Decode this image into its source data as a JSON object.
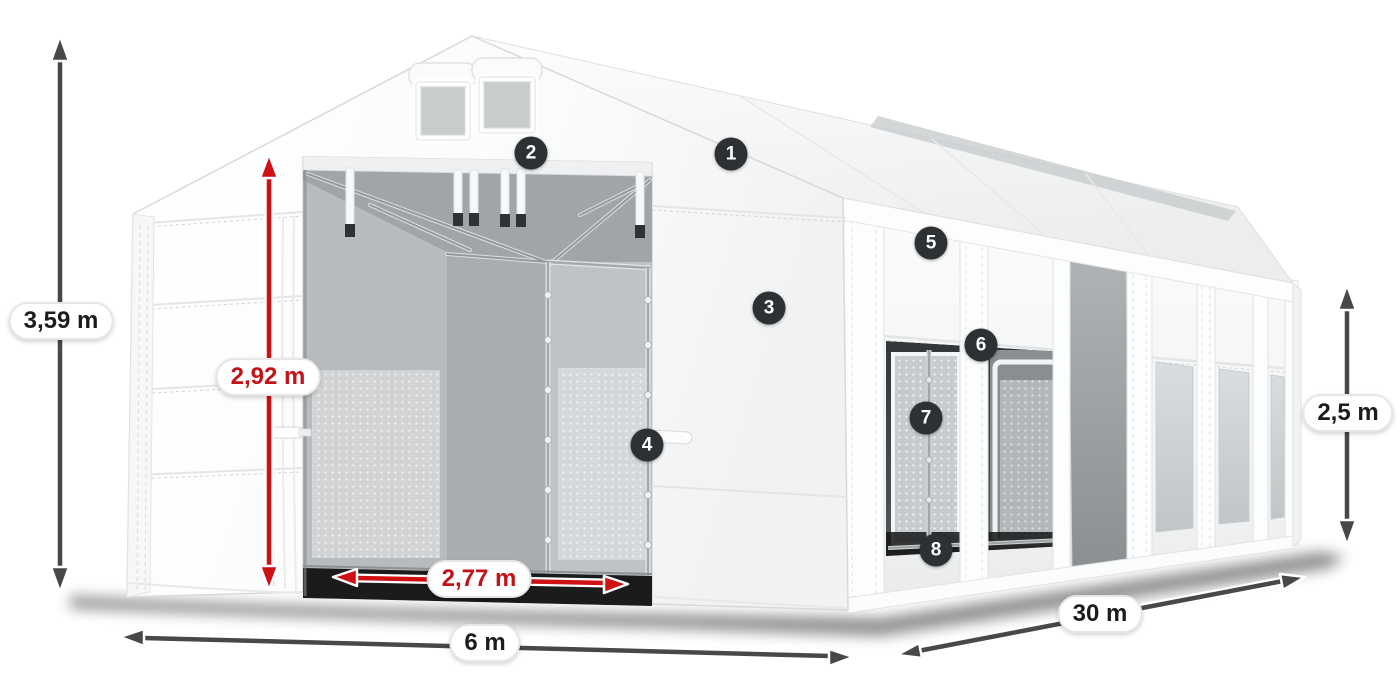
{
  "colors": {
    "badge_bg": "#2e3133",
    "badge_text": "#ffffff",
    "arrow_dark": "#474849",
    "arrow_red": "#cd1115",
    "label_bg": "#ffffff",
    "label_border": "#e6e6e6",
    "label_text_dark": "#1c1c1c",
    "label_text_red": "#c31318",
    "tent_white": "#ffffff",
    "tent_shade": "#eceeef",
    "interior_gray": "#a8abad",
    "window_gray": "#d4d7d9"
  },
  "badges": [
    "1",
    "2",
    "3",
    "4",
    "5",
    "6",
    "7",
    "8"
  ],
  "dimensions": {
    "total_height": {
      "value": "3,59 m",
      "style": "dark"
    },
    "door_height": {
      "value": "2,92 m",
      "style": "red"
    },
    "door_width": {
      "value": "2,77 m",
      "style": "red"
    },
    "front_width": {
      "value": "6 m",
      "style": "dark"
    },
    "side_length": {
      "value": "30 m",
      "style": "dark"
    },
    "side_height": {
      "value": "2,5 m",
      "style": "dark"
    }
  }
}
